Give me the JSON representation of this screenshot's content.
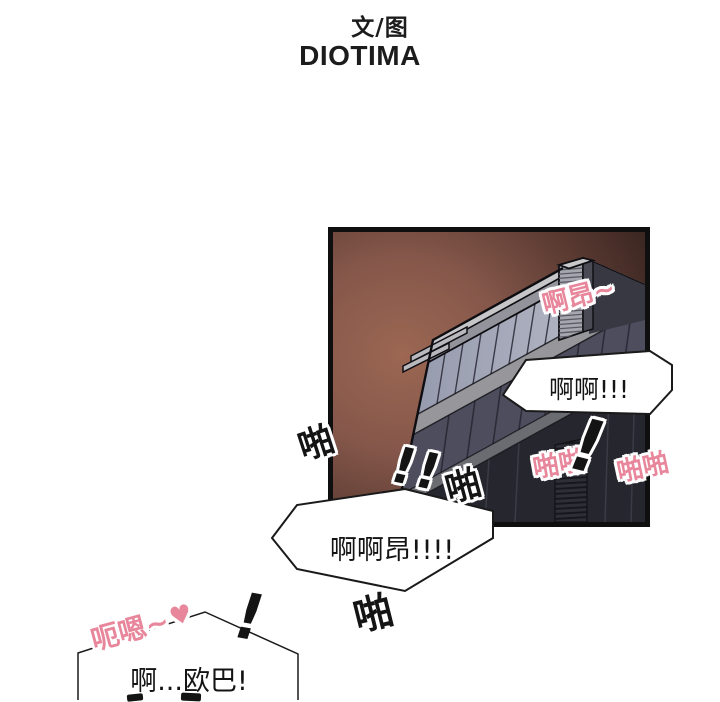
{
  "credits": {
    "byline": "文/图",
    "author": "DIOTIMA"
  },
  "speech_bubbles": {
    "top": {
      "text": "啊啊!!!"
    },
    "middle": {
      "text": "啊啊昂!!!!"
    },
    "bottom": {
      "line1": "啊...欧巴!"
    }
  },
  "sound_effects": {
    "moan_top": "啊昂~",
    "slap_double_inner": "啪啪",
    "slap_double_outer": "啪啪",
    "slap_left": "啪",
    "slap_center": "啪",
    "slap_bottom": "啪",
    "exclaim_double": "!!",
    "exclaim_top": "!",
    "exclaim_bottom": "!",
    "moan_bottom": "呃嗯~",
    "heart": "♥"
  },
  "colors": {
    "sfx_pink": "#e8879b",
    "panel_border": "#0f0f10",
    "bubble_fill": "#ffffff",
    "bubble_border": "#1a1a1a"
  }
}
